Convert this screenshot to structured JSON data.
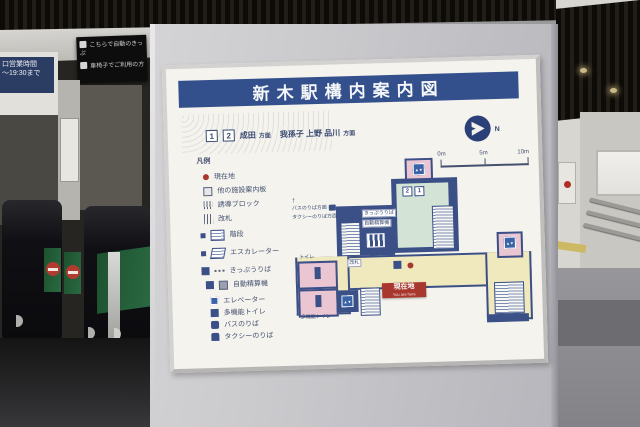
{
  "scene": {
    "hours_sign": {
      "line1": "口営業時間",
      "line2": "〜19:30まで"
    },
    "dark_sign": {
      "line1": "こちらで自動のきっぷ",
      "line2": "車椅子でご利用の方"
    }
  },
  "board": {
    "title": "新木駅構内案内図",
    "route": {
      "badge1": "1",
      "badge2": "2",
      "dest_left": "成田",
      "suffix_left": "方面",
      "dest_right": "我孫子 上野 品川",
      "suffix_right": "方面"
    },
    "compass_label": "N",
    "scale": {
      "t0": "0m",
      "t1": "5m",
      "t2": "10m"
    },
    "legend": {
      "header": "凡例",
      "items": [
        {
          "icon": "current-location-dot",
          "label": "現在地"
        },
        {
          "icon": "info-board",
          "label": "他の施設案内板"
        },
        {
          "icon": "tactile-block",
          "label": "誘導ブロック"
        },
        {
          "icon": "ticket-gate",
          "label": "改札"
        },
        {
          "icon": "stairs",
          "label": "階段"
        },
        {
          "icon": "escalator",
          "label": "エスカレーター"
        },
        {
          "icon": "ticket-office",
          "label": "きっぷうりば"
        },
        {
          "icon": "fare-adjustment-machine",
          "label": "自動精算機"
        },
        {
          "icon": "elevator",
          "label": "エレベーター"
        },
        {
          "icon": "accessible-toilet",
          "label": "多機能トイレ"
        },
        {
          "icon": "bus-stop",
          "label": "バスのりば"
        },
        {
          "icon": "taxi-stand",
          "label": "タクシーのりば"
        }
      ]
    },
    "map": {
      "platform_badge_left": "2",
      "platform_badge_right": "1",
      "you_are_here": "現在地",
      "you_are_here_sub": "You are here",
      "bus_direction": "バスのりば方面",
      "taxi_direction": "タクシーのりば方面",
      "up_arrow": "↑",
      "gate_label": "改札",
      "ticket_office_label": "きっぷうりば",
      "fare_machine_label": "自動精算機",
      "toilet_label": "トイレ",
      "multi_toilet_label": "多機能トイレ",
      "ev_glyph": "▲▼"
    }
  }
}
